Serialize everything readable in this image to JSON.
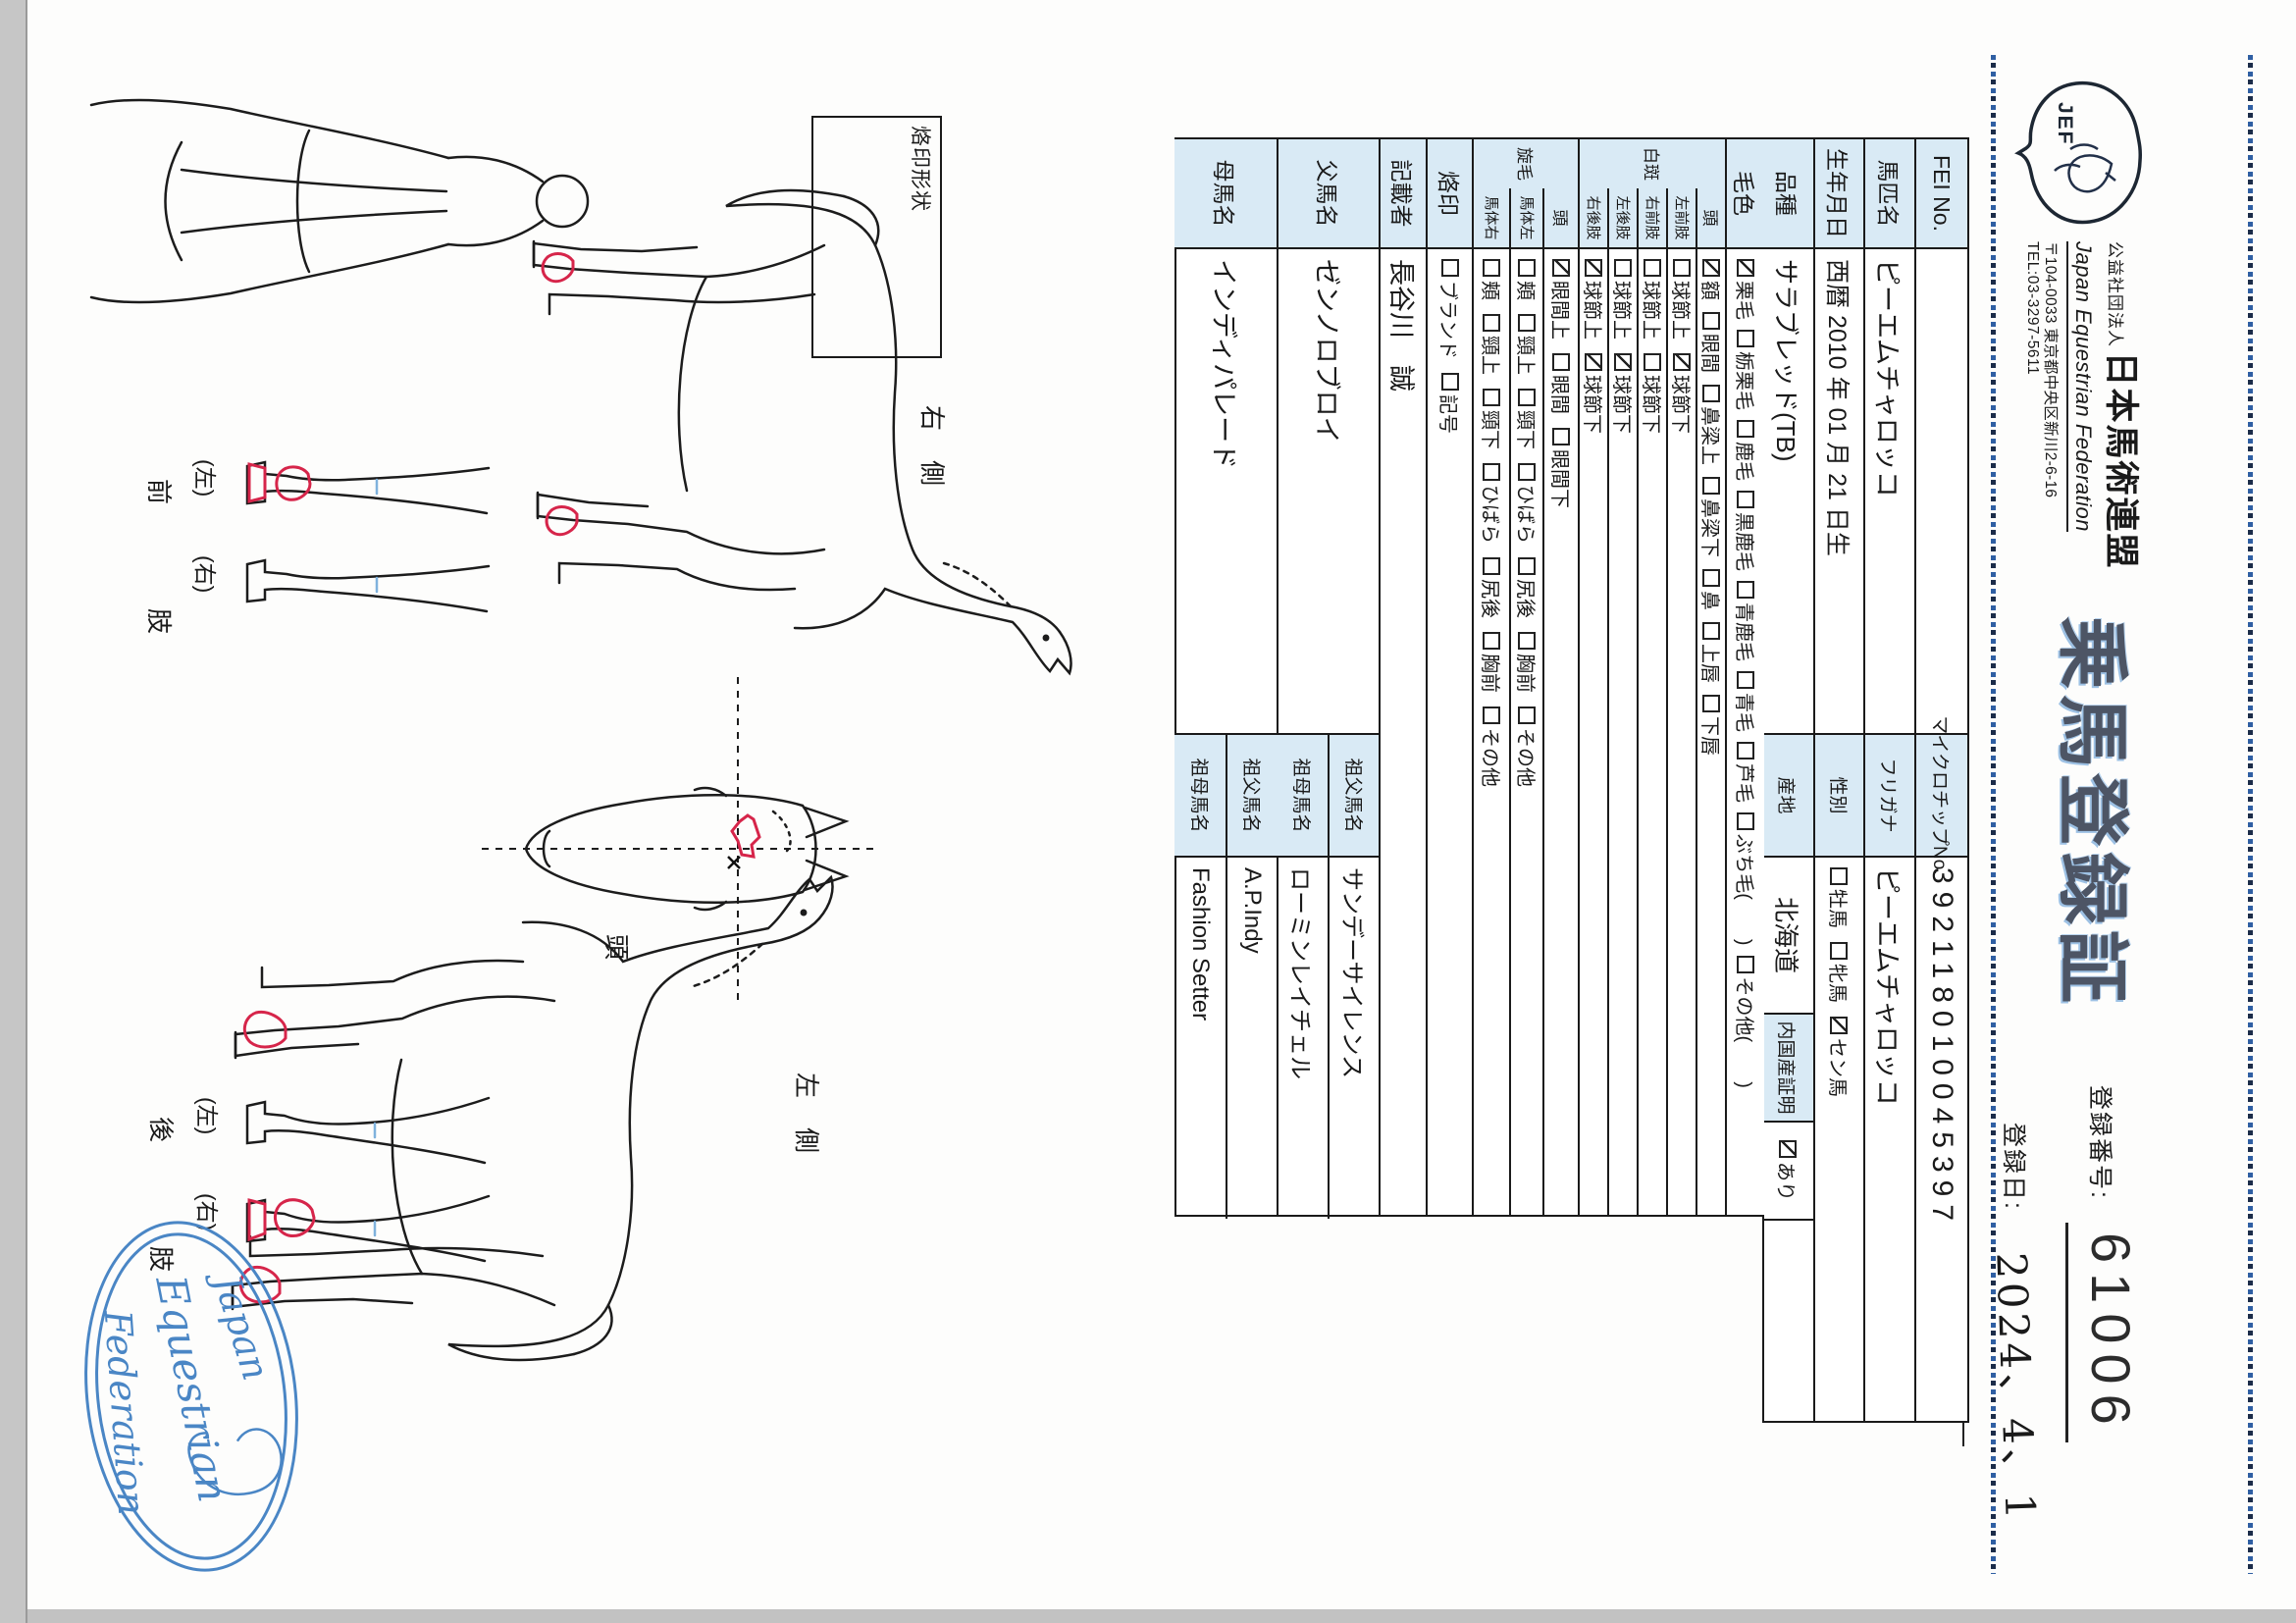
{
  "header": {
    "logo_text": "JEF",
    "org_small": "公益社団法人",
    "org_large": "日本馬術連盟",
    "org_en": "Japan Equestrian Federation",
    "address": "〒104-0033 東京都中央区新川2-6-16",
    "tel": "TEL:03-3297-5611",
    "title": "乗馬登録証",
    "reg_no_label": "登録番号:",
    "reg_no": "61006",
    "reg_date_label": "登録日:",
    "reg_date": "2024、4、1"
  },
  "table": {
    "fei": {
      "label": "FEI No.",
      "chip_label": "マイクロチップNo.",
      "chip": "392118010045397"
    },
    "name": {
      "label": "馬匹名",
      "value": "ピーエムチャロッコ",
      "kana_label": "フリガナ",
      "kana": "ピーエムチャロッコ"
    },
    "birth": {
      "label": "生年月日",
      "value": "西暦 2010 年 01 月 21 日生",
      "sex_label": "性別",
      "sex_options": [
        {
          "label": "牡馬",
          "checked": false
        },
        {
          "label": "牝馬",
          "checked": false
        },
        {
          "label": "セン馬",
          "checked": true
        }
      ]
    },
    "breed": {
      "label": "品種",
      "value": "サラブレッド(TB)",
      "origin_label": "産地",
      "origin": "北海道",
      "domestic_label": "内国産証明",
      "domestic_options": [
        {
          "label": "あり",
          "checked": true
        }
      ]
    },
    "coat": {
      "label": "毛色",
      "options": [
        {
          "label": "栗毛",
          "checked": true
        },
        {
          "label": "栃栗毛",
          "checked": false
        },
        {
          "label": "鹿毛",
          "checked": false
        },
        {
          "label": "黒鹿毛",
          "checked": false
        },
        {
          "label": "青鹿毛",
          "checked": false
        },
        {
          "label": "青毛",
          "checked": false
        },
        {
          "label": "芦毛",
          "checked": false
        },
        {
          "label": "ぶち毛(　　)",
          "checked": false
        },
        {
          "label": "その他(　　)",
          "checked": false
        }
      ]
    },
    "hakuhan": {
      "label": "白斑",
      "rows": [
        {
          "label": "頭",
          "options": [
            {
              "label": "額",
              "checked": true
            },
            {
              "label": "眼間",
              "checked": false
            },
            {
              "label": "鼻梁上",
              "checked": false
            },
            {
              "label": "鼻梁下",
              "checked": false
            },
            {
              "label": "鼻",
              "checked": false
            },
            {
              "label": "上唇",
              "checked": false
            },
            {
              "label": "下唇",
              "checked": false
            }
          ]
        },
        {
          "label": "左前肢",
          "options": [
            {
              "label": "球節上",
              "checked": false
            },
            {
              "label": "球節下",
              "checked": true
            }
          ]
        },
        {
          "label": "右前肢",
          "options": [
            {
              "label": "球節上",
              "checked": false
            },
            {
              "label": "球節下",
              "checked": false
            }
          ]
        },
        {
          "label": "左後肢",
          "options": [
            {
              "label": "球節上",
              "checked": false
            },
            {
              "label": "球節下",
              "checked": true
            }
          ]
        },
        {
          "label": "右後肢",
          "options": [
            {
              "label": "球節上",
              "checked": true
            },
            {
              "label": "球節下",
              "checked": true
            }
          ]
        }
      ]
    },
    "senmou": {
      "label": "旋毛",
      "rows": [
        {
          "label": "頭",
          "options": [
            {
              "label": "眼間上",
              "checked": true
            },
            {
              "label": "眼間",
              "checked": false
            },
            {
              "label": "眼間下",
              "checked": false
            }
          ]
        },
        {
          "label": "馬体左",
          "options": [
            {
              "label": "頬",
              "checked": false
            },
            {
              "label": "頸上",
              "checked": false
            },
            {
              "label": "頸下",
              "checked": false
            },
            {
              "label": "ひばら",
              "checked": false
            },
            {
              "label": "尻後",
              "checked": false
            },
            {
              "label": "胸前",
              "checked": false
            },
            {
              "label": "その他",
              "checked": false
            }
          ]
        },
        {
          "label": "馬体右",
          "options": [
            {
              "label": "頬",
              "checked": false
            },
            {
              "label": "頸上",
              "checked": false
            },
            {
              "label": "頸下",
              "checked": false
            },
            {
              "label": "ひばら",
              "checked": false
            },
            {
              "label": "尻後",
              "checked": false
            },
            {
              "label": "胸前",
              "checked": false
            },
            {
              "label": "その他",
              "checked": false
            }
          ]
        }
      ]
    },
    "rakuin": {
      "label": "烙印",
      "options": [
        {
          "label": "ブランド",
          "checked": false
        },
        {
          "label": "記号",
          "checked": false
        }
      ]
    },
    "recorder": {
      "label": "記載者",
      "value": "長谷川　誠"
    },
    "sire": {
      "label": "父馬名",
      "value": "ゼンノロブロイ",
      "gs_label": "祖父馬名",
      "gs": "サンデーサイレンス",
      "gd_label": "祖母馬名",
      "gd": "ローミンレイチェル"
    },
    "dam": {
      "label": "母馬名",
      "value": "インディパレード",
      "gs_label": "祖父馬名",
      "gs": "A.P.Indy",
      "gd_label": "祖母馬名",
      "gd": "Fashion Setter"
    }
  },
  "diagrams": {
    "brand_box_label": "烙印形状",
    "right_side_label": "右　側",
    "left_side_label": "左　側",
    "head_label": "頭",
    "left_paren": "(左)",
    "right_paren": "(右)",
    "foreleg_label": "前　肢",
    "hindleg_label": "後　肢",
    "stamp_line1": "Japan",
    "stamp_line2": "Equestrian",
    "stamp_line3": "Federation"
  },
  "colors": {
    "label_cell_bg": "#d9eaf5",
    "stamp_blue": "#4a86c5",
    "marking_red": "#d6254a",
    "title_ink": "#4d5565",
    "border_ink": "#1a1a1a"
  }
}
